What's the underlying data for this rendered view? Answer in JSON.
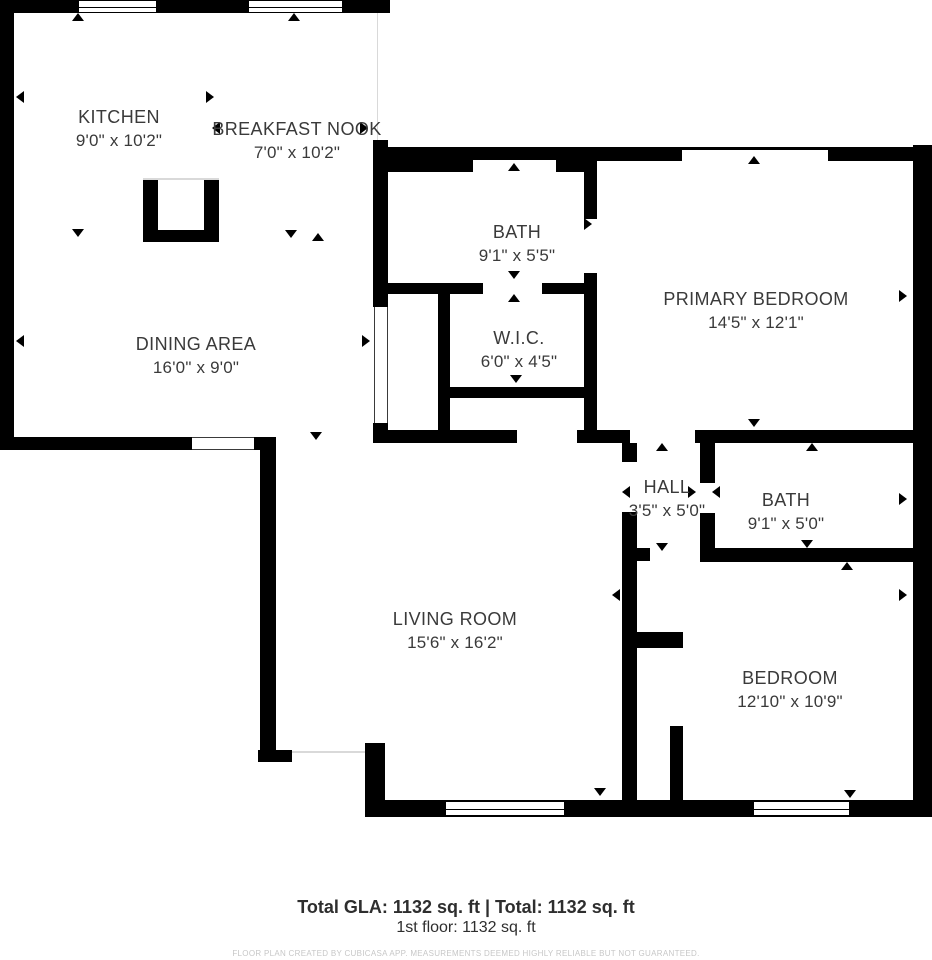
{
  "plan": {
    "rooms": [
      {
        "name": "KITCHEN",
        "dims": "9'0\" x 10'2\""
      },
      {
        "name": "BREAKFAST NOOK",
        "dims": "7'0\" x 10'2\""
      },
      {
        "name": "BATH",
        "dims": "9'1\" x 5'5\""
      },
      {
        "name": "PRIMARY BEDROOM",
        "dims": "14'5\" x 12'1\""
      },
      {
        "name": "W.I.C.",
        "dims": "6'0\" x 4'5\""
      },
      {
        "name": "DINING AREA",
        "dims": "16'0\" x 9'0\""
      },
      {
        "name": "HALL",
        "dims": "3'5\" x 5'0\""
      },
      {
        "name": "BATH",
        "dims": "9'1\" x 5'0\""
      },
      {
        "name": "LIVING ROOM",
        "dims": "15'6\" x 16'2\""
      },
      {
        "name": "BEDROOM",
        "dims": "12'10\" x 10'9\""
      }
    ],
    "summary": {
      "total_line": "Total GLA: 1132 sq. ft | Total: 1132 sq. ft",
      "floor_line": "1st floor: 1132 sq. ft"
    },
    "footer": {
      "disclaimer": "FLOOR PLAN CREATED BY CUBICASA APP. MEASUREMENTS DEEMED HIGHLY RELIABLE BUT NOT GUARANTEED."
    },
    "colors": {
      "wall": "#000000",
      "text": "#3a3a3a",
      "muted": "#c7c7c7"
    }
  }
}
